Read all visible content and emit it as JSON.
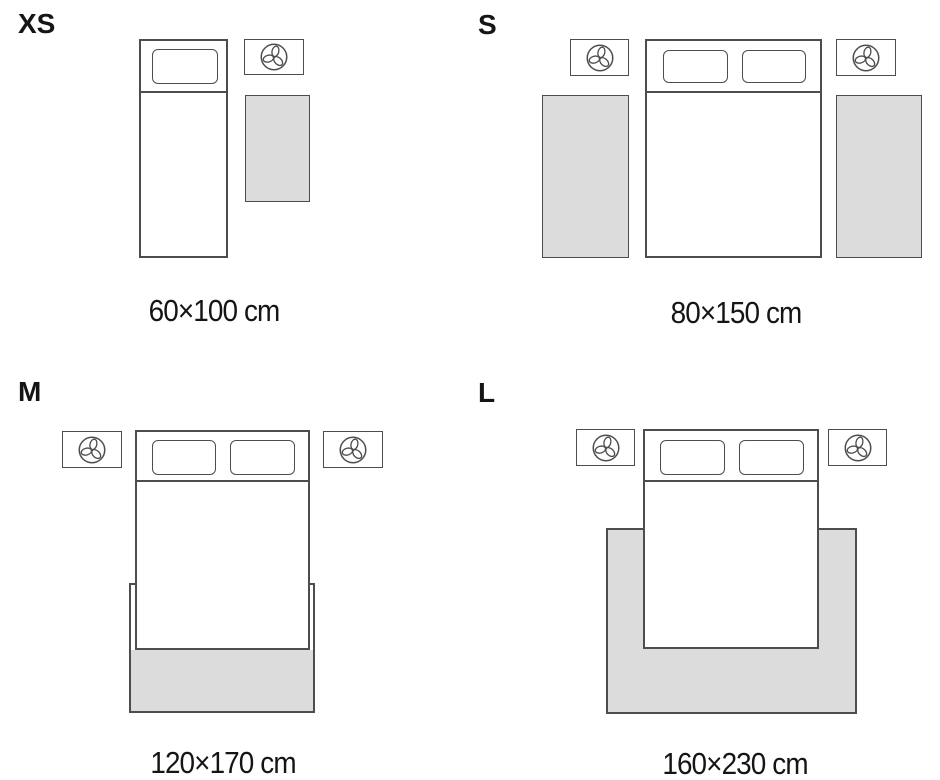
{
  "sizes": [
    {
      "label": "XS",
      "dimensions": "60×100 cm"
    },
    {
      "label": "S",
      "dimensions": "80×150 cm"
    },
    {
      "label": "M",
      "dimensions": "120×170 cm"
    },
    {
      "label": "L",
      "dimensions": "160×230 cm"
    }
  ],
  "icons": {
    "nightstand": "plant-icon"
  },
  "colors": {
    "outline": "#4d4d4d",
    "rug_fill": "#dcdcdc",
    "text": "#151515",
    "background": "#ffffff"
  }
}
